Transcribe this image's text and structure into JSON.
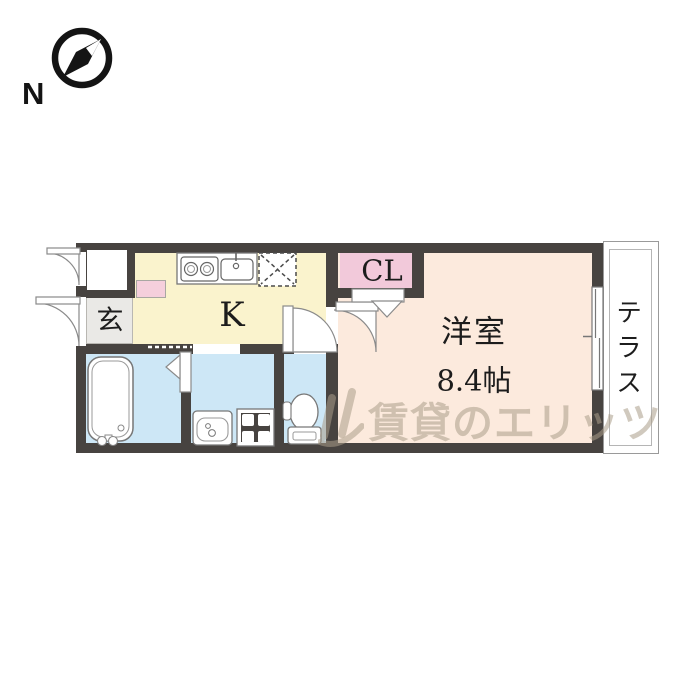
{
  "compass": {
    "north_label": "N"
  },
  "plan": {
    "genkan_label": "玄",
    "kitchen_label": "K",
    "closet_label": "CL",
    "room_label": "洋室",
    "room_size": "8.4帖",
    "terrace_label": "テラス"
  },
  "watermark": {
    "brand_text": "賃貸のエリッツ"
  },
  "fixtures": {
    "kitchen": [
      "gas-stove",
      "kitchen-sink",
      "refrigerator-space"
    ],
    "bathroom": [
      "bathtub",
      "folding-door"
    ],
    "washroom": [
      "washbasin",
      "washing-machine-pan"
    ],
    "toilet": [
      "toilet-bowl"
    ],
    "room": [
      "sliding-window",
      "closet-folding-door",
      "swing-door"
    ]
  },
  "colors": {
    "wall": "#474340",
    "kitchen_floor": "#faf3cd",
    "room_floor": "#fceadd",
    "wet_floor": "#cde7f6",
    "closet_pink": "#f2c9da",
    "cabinet_pink": "#f5cfdc",
    "genkan_gray": "#eae9e6"
  }
}
